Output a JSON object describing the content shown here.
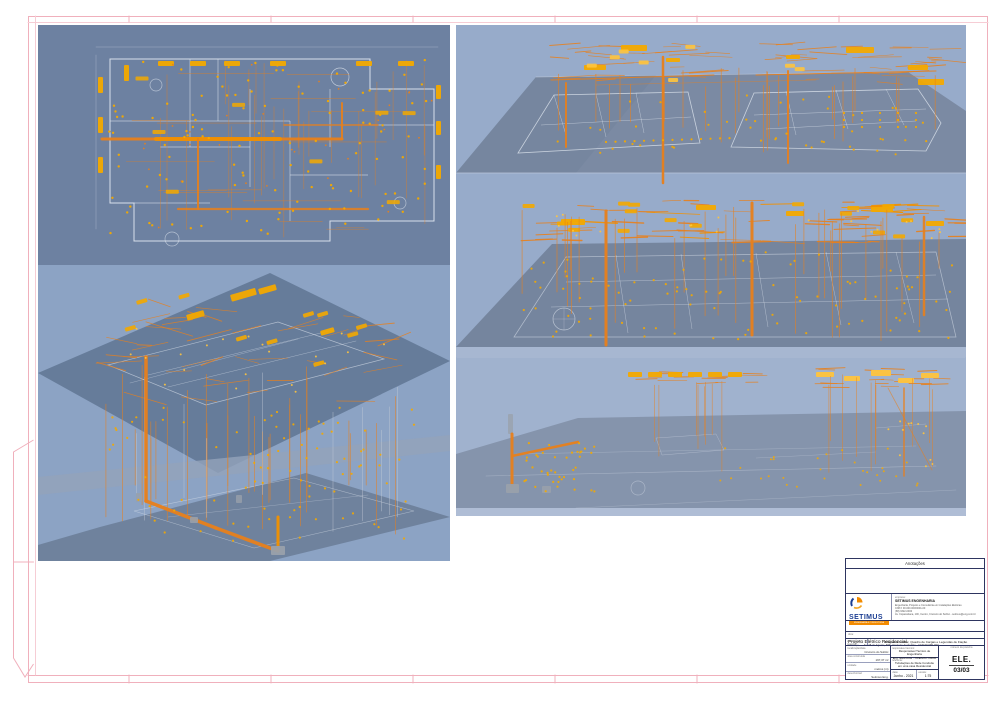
{
  "colors": {
    "frame": "#f0b0bc",
    "frame_light": "#f6cdd5",
    "panel_dark": "#6d81a1",
    "panel_light": "#8ca3c4",
    "panel_light2": "#97abca",
    "slab": "#7b8aa3",
    "slab_dark": "#75859e",
    "slab_light": "#a9b8d2",
    "plane": "#5f7593",
    "conduit": "#e8801c",
    "conduit_bright": "#f29100",
    "fixture": "#f3a900",
    "fixture_bright": "#ffc43d",
    "plan_line": "#e3e9f2",
    "gray_box": "#99a0ab",
    "title_border": "#2e3560",
    "logo_blue": "#1c3e92",
    "logo_orange": "#f28b00"
  },
  "title_block": {
    "annotations_label": "Anotações",
    "company": {
      "label": "empresa:",
      "name": "SETIMUS ENGENHARIA",
      "logo_text": "SETIMUS",
      "logo_bar": "ENGENHARIA & CONSULTORIA",
      "details": [
        "Engenharia, Projetos e Consultoria em Instalações Elétricas",
        "CNPJ: 00.000.000/0001-00",
        "(68) 3322-0000",
        "Av. Copacabana, 100, Centro, Cruzeiro do Sul/Ac - setimus@eng.com.br"
      ]
    },
    "project": {
      "label": "obra:",
      "value": "Projeto Elétrico Residencial"
    },
    "address": {
      "label": "endereço:",
      "value": "Av. 25 de Agosto, 505, Cruzeiro do Sul/Ac - CEP 69.980-000"
    },
    "content": {
      "label": "conteúdo da prancha:",
      "value": "Diagrama Unifilar, Quadro de Cargas e Legendas de Fiação"
    },
    "fields": [
      {
        "label": "localização/data",
        "value": "Cruzeiro do Sul/Ac"
      },
      {
        "label": "área construída",
        "value": "197,37 m²"
      },
      {
        "label": "unidade",
        "value": "metros (m)"
      },
      {
        "label": "desenho/cad",
        "value": "Setimus Eng."
      }
    ],
    "responsible": {
      "label": "responsável técnico:",
      "lines": [
        "Responsável Técnico de Engenharia",
        "Eng. Eletricista - CREA/AC 00000"
      ]
    },
    "subject": {
      "label": "referente:",
      "lines": [
        "Tubulações de Rede Conduíte",
        "em uma casa Residencial"
      ]
    },
    "sheet": {
      "label": "número da prancha",
      "code": "ELE.",
      "number": "03/03"
    },
    "footer": {
      "date_label": "data:",
      "date": "Junho - 2021",
      "scale_label": "escala:",
      "scale": "1:75"
    }
  }
}
